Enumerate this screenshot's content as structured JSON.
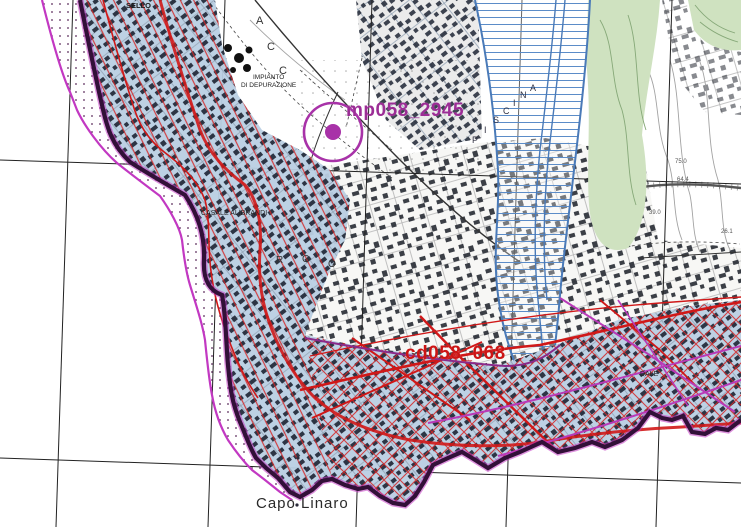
{
  "map": {
    "description": "Coastal hazard zoning map over Italian topographic base, Capo Linaro area",
    "colors": {
      "sea": "#ffffff",
      "hazard_zone_fill": "#b9cfe3",
      "hazard_hatch_red": "#d42525",
      "boundary_magenta": "#c238c2",
      "boundary_dark_purple": "#321038",
      "river_corridor_blue": "#4a7ab8",
      "vegetation_green": "#cfe2c0",
      "building_dark": "#1d2433",
      "graticule_black": "#222222",
      "monitoring_marker": "#a832a8",
      "zone_code_red": "#cc1414"
    },
    "markers": [
      {
        "name": "monitoring-point",
        "code": "mp058_2945",
        "x": 333,
        "y": 132,
        "radius": 29,
        "dot_radius": 8,
        "color": "#a832a8"
      },
      {
        "name": "hazard-zone-code",
        "code": "cd058_068",
        "x": 405,
        "y": 344,
        "color": "#cc1414"
      }
    ],
    "labels": [
      {
        "name": "monitoring-point-label",
        "text": "mp058_2945",
        "x": 346,
        "y": 101,
        "size": 19,
        "color": "#9c2d96",
        "weight": "bold"
      },
      {
        "name": "zone-code-label",
        "text": "cd058_068",
        "x": 405,
        "y": 344,
        "size": 19,
        "color": "#cc1414",
        "weight": "bold"
      },
      {
        "name": "capo-linaro-label",
        "text": "Capo Linaro",
        "x": 256,
        "y": 496,
        "size": 15,
        "color": "#2a2a2a",
        "weight": "normal",
        "ls": 1
      },
      {
        "name": "locality-label-top",
        "text": "SELLO",
        "x": 126,
        "y": 2,
        "size": 7.5,
        "color": "#1a1a1a",
        "weight": "bold"
      },
      {
        "name": "impianto-label-line1",
        "text": "IMPIANTO",
        "x": 253,
        "y": 75,
        "size": 6.5,
        "color": "#222222",
        "weight": "normal"
      },
      {
        "name": "impianto-label-line2",
        "text": "DI DEPURAZIONE",
        "x": 241,
        "y": 83,
        "size": 6.5,
        "color": "#222222",
        "weight": "normal"
      },
      {
        "name": "casale-label",
        "text": "CASALE ALIBRANDI",
        "x": 201,
        "y": 210,
        "size": 7,
        "color": "#222222",
        "weight": "normal"
      },
      {
        "name": "street-label-fragment",
        "text": "DALE",
        "x": 640,
        "y": 371,
        "size": 7,
        "color": "#222222",
        "weight": "normal"
      },
      {
        "name": "stream-name-letter",
        "text": "P",
        "x": 472,
        "y": 136,
        "size": 9,
        "color": "#333344",
        "weight": "normal"
      },
      {
        "name": "stream-name-letter",
        "text": "I",
        "x": 484,
        "y": 126,
        "size": 9,
        "color": "#333344",
        "weight": "normal"
      },
      {
        "name": "stream-name-letter",
        "text": "S",
        "x": 493,
        "y": 116,
        "size": 9,
        "color": "#333344",
        "weight": "normal"
      },
      {
        "name": "stream-name-letter",
        "text": "C",
        "x": 503,
        "y": 107,
        "size": 9,
        "color": "#333344",
        "weight": "normal"
      },
      {
        "name": "stream-name-letter",
        "text": "I",
        "x": 513,
        "y": 99,
        "size": 9,
        "color": "#333344",
        "weight": "normal"
      },
      {
        "name": "stream-name-letter",
        "text": "N",
        "x": 520,
        "y": 91,
        "size": 9,
        "color": "#333344",
        "weight": "normal"
      },
      {
        "name": "stream-name-letter",
        "text": "A",
        "x": 530,
        "y": 84,
        "size": 9,
        "color": "#333344",
        "weight": "normal"
      },
      {
        "name": "place-name-letter",
        "text": "A",
        "x": 256,
        "y": 16,
        "size": 11,
        "color": "#333333",
        "weight": "normal"
      },
      {
        "name": "place-name-letter",
        "text": "C",
        "x": 267,
        "y": 42,
        "size": 11,
        "color": "#333333",
        "weight": "normal"
      },
      {
        "name": "place-name-letter",
        "text": "C",
        "x": 279,
        "y": 66,
        "size": 11,
        "color": "#333333",
        "weight": "normal"
      },
      {
        "name": "place-name-letter",
        "text": "R",
        "x": 276,
        "y": 256,
        "size": 10,
        "color": "#333333",
        "weight": "normal"
      },
      {
        "name": "place-name-letter",
        "text": "G",
        "x": 302,
        "y": 255,
        "size": 10,
        "color": "#333333",
        "weight": "normal"
      },
      {
        "name": "place-name-letter",
        "text": "O",
        "x": 328,
        "y": 260,
        "size": 10,
        "color": "#333333",
        "weight": "normal"
      },
      {
        "name": "spot-height",
        "text": "75.0",
        "x": 675,
        "y": 159,
        "size": 6,
        "color": "#555555",
        "weight": "normal"
      },
      {
        "name": "spot-height",
        "text": "64.4",
        "x": 677,
        "y": 177,
        "size": 6,
        "color": "#555555",
        "weight": "normal"
      },
      {
        "name": "spot-height",
        "text": "39.0",
        "x": 649,
        "y": 210,
        "size": 6,
        "color": "#555555",
        "weight": "normal"
      },
      {
        "name": "spot-height",
        "text": "26.1",
        "x": 721,
        "y": 229,
        "size": 6,
        "color": "#555555",
        "weight": "normal"
      }
    ]
  }
}
